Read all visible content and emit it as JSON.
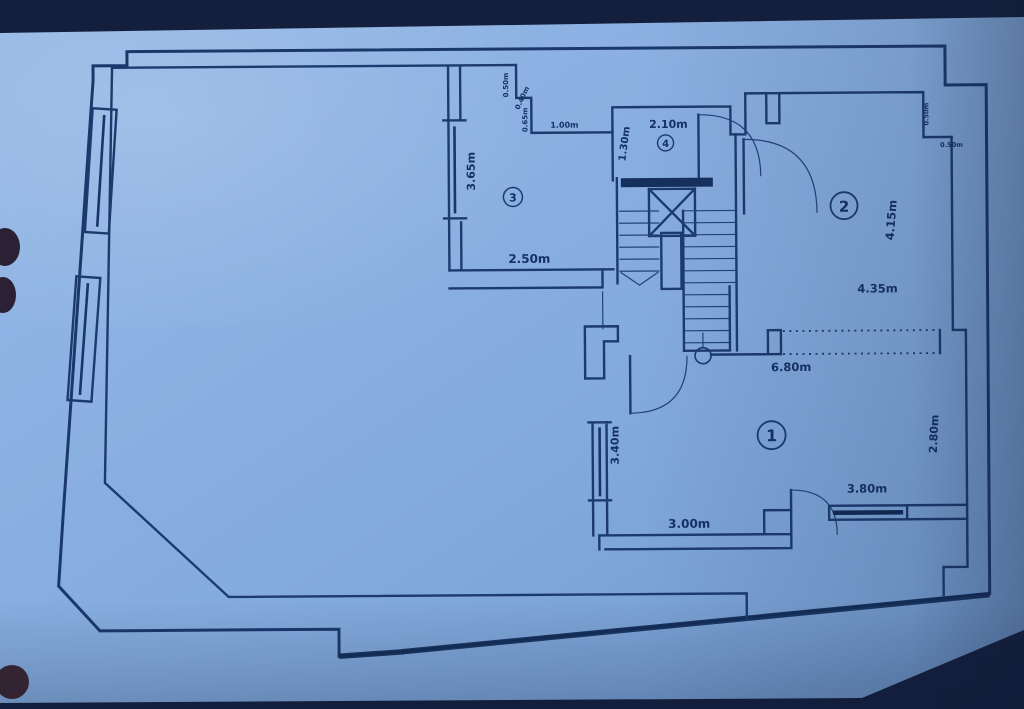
{
  "figure": {
    "kind": "floor-plan-photo",
    "colors": {
      "paper": "#87acdc",
      "ink": "#1c3a6e",
      "photo_background": "#131f3c"
    },
    "rooms": [
      {
        "id": "1"
      },
      {
        "id": "2"
      },
      {
        "id": "3"
      },
      {
        "id": "4"
      }
    ],
    "labels": {
      "room1_number": "1",
      "room2_number": "2",
      "room3_number": "3",
      "room4_number": "4",
      "room3_left_wall": "3.65m",
      "room3_bottom_wall": "2.50m",
      "step_vertical_upper": "0.50m",
      "step_horizontal": "0.40m",
      "step_vertical_lower": "0.65m",
      "corridor_top": "1.00m",
      "room4_width": "2.10m",
      "room4_height": "1.30m",
      "room2_height": "4.15m",
      "room2_width": "4.35m",
      "room2_notch_vertical": "0.50m",
      "room2_notch_horizontal": "0.50m",
      "opening_width": "6.80m",
      "area1_right_wall": "2.80m",
      "area1_left_window": "3.40m",
      "area1_bottom_wall": "3.00m",
      "area1_bottom_window": "3.80m"
    }
  }
}
